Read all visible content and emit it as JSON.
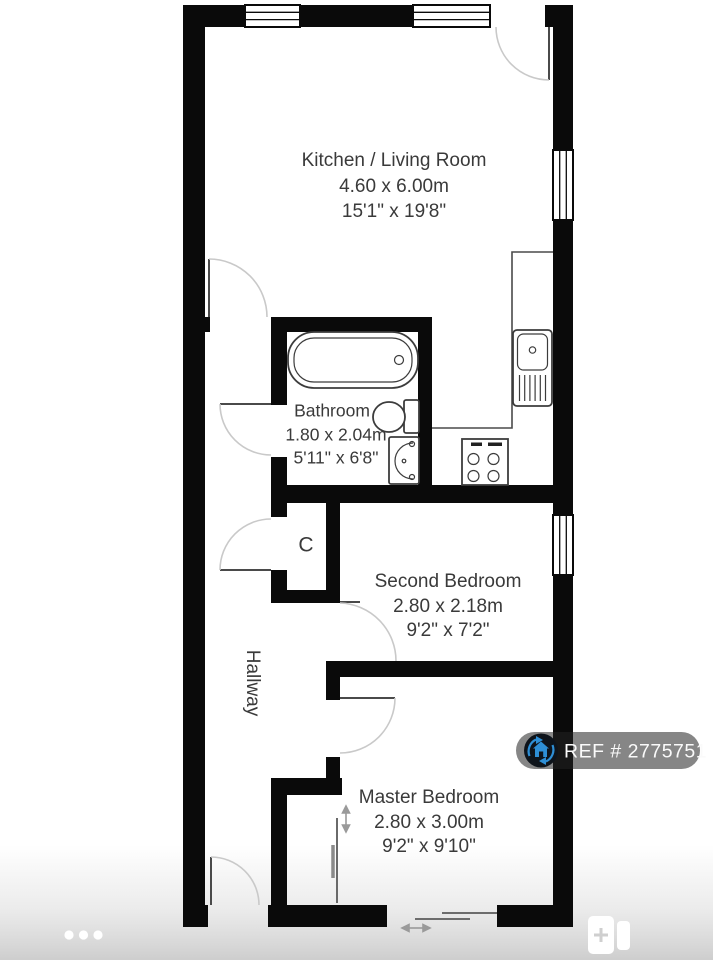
{
  "floorplan": {
    "rooms": [
      {
        "name": "Kitchen / Living Room",
        "metric": "4.60 x 6.00m",
        "imperial": "15'1\" x 19'8\""
      },
      {
        "name": "Bathroom",
        "metric": "1.80 x 2.04m",
        "imperial": "5'11\" x 6'8\""
      },
      {
        "name": "Second Bedroom",
        "metric": "2.80 x 2.18m",
        "imperial": "9'2\" x 7'2\""
      },
      {
        "name": "Master Bedroom",
        "metric": "2.80 x 3.00m",
        "imperial": "9'2\" x 9'10\""
      }
    ],
    "hallway_label": "Hallway",
    "closet_label": "C",
    "wall_color": "#0a0a0a",
    "text_color": "#3a3a3a"
  },
  "ref_badge": {
    "label": "REF # 2775751",
    "bg_color": "rgba(35,35,35,0.55)",
    "icon": "house-circular-arrows-icon",
    "icon_accent": "#2e8fd6",
    "icon_bg": "#0e141b"
  },
  "carousel": {
    "dot_count": 3,
    "dot_color": "#ffffff"
  },
  "gallery_icon": {
    "name": "floorplan-pages-icon",
    "plus_color": "#cfcfcf"
  }
}
